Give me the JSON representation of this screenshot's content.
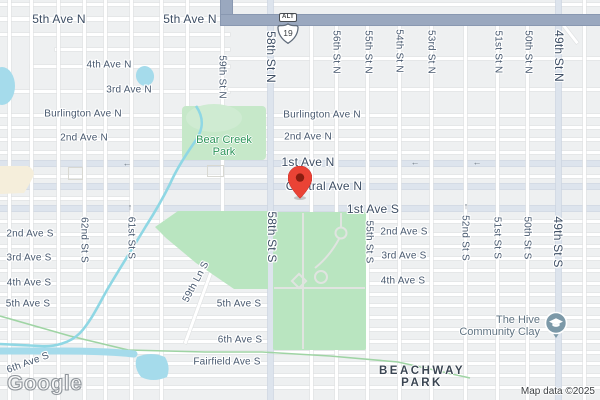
{
  "map": {
    "logo": "Google",
    "attribution": "Map data ©2025",
    "route_shield": {
      "banner": "ALT",
      "number": "19"
    },
    "marker": {
      "label": "Dropped pin",
      "color": "#EA4335"
    },
    "poi": {
      "line1": "The Hive",
      "line2": "Community Clay",
      "icon": "school-pin-icon",
      "color": "#7c99a8"
    },
    "parks": {
      "bear_creek": {
        "line1": "Bear Creek",
        "line2": "Park"
      },
      "beachway": {
        "line1": "BEACHWAY",
        "line2": "PARK"
      }
    },
    "street_labels": [
      {
        "text": "5th Ave N",
        "x": 59,
        "y": 19,
        "size": "lg"
      },
      {
        "text": "5th Ave N",
        "x": 190,
        "y": 19,
        "size": "lg"
      },
      {
        "text": "4th Ave N",
        "x": 109,
        "y": 65,
        "size": "md"
      },
      {
        "text": "3rd Ave N",
        "x": 129,
        "y": 90,
        "size": "md"
      },
      {
        "text": "Burlington Ave N",
        "x": 83,
        "y": 114,
        "size": "md"
      },
      {
        "text": "Burlington Ave N",
        "x": 322,
        "y": 115,
        "size": "md"
      },
      {
        "text": "2nd Ave N",
        "x": 84,
        "y": 138,
        "size": "md"
      },
      {
        "text": "2nd Ave N",
        "x": 308,
        "y": 137,
        "size": "md"
      },
      {
        "text": "1st Ave N",
        "x": 308,
        "y": 162,
        "size": "lg"
      },
      {
        "text": "Central Ave N",
        "x": 324,
        "y": 186,
        "size": "lg"
      },
      {
        "text": "1st Ave S",
        "x": 373,
        "y": 209,
        "size": "lg"
      },
      {
        "text": "2nd Ave S",
        "x": 30,
        "y": 234,
        "size": "md"
      },
      {
        "text": "2nd Ave S",
        "x": 404,
        "y": 232,
        "size": "md"
      },
      {
        "text": "3rd Ave S",
        "x": 29,
        "y": 258,
        "size": "md"
      },
      {
        "text": "3rd Ave S",
        "x": 404,
        "y": 256,
        "size": "md"
      },
      {
        "text": "4th Ave S",
        "x": 29,
        "y": 283,
        "size": "md"
      },
      {
        "text": "4th Ave S",
        "x": 403,
        "y": 281,
        "size": "md"
      },
      {
        "text": "5th Ave S",
        "x": 28,
        "y": 304,
        "size": "md"
      },
      {
        "text": "5th Ave S",
        "x": 239,
        "y": 304,
        "size": "md"
      },
      {
        "text": "6th Ave S",
        "x": 240,
        "y": 340,
        "size": "md"
      },
      {
        "text": "Fairfield Ave S",
        "x": 227,
        "y": 362,
        "size": "md"
      },
      {
        "text": "6th Ave S",
        "x": 28,
        "y": 363,
        "size": "md",
        "rot": -20
      },
      {
        "text": "59th Ln S",
        "x": 196,
        "y": 282,
        "size": "md",
        "rot": -62
      },
      {
        "text": "59th St N",
        "x": 222,
        "y": 77,
        "size": "md",
        "vert": true
      },
      {
        "text": "58th St N",
        "x": 271,
        "y": 57,
        "size": "lg",
        "vert": true
      },
      {
        "text": "56th St N",
        "x": 336,
        "y": 52,
        "size": "md",
        "vert": true
      },
      {
        "text": "55th St N",
        "x": 368,
        "y": 52,
        "size": "md",
        "vert": true
      },
      {
        "text": "54th St N",
        "x": 399,
        "y": 51,
        "size": "md",
        "vert": true
      },
      {
        "text": "53rd St N",
        "x": 431,
        "y": 52,
        "size": "md",
        "vert": true
      },
      {
        "text": "51st St N",
        "x": 498,
        "y": 52,
        "size": "md",
        "vert": true
      },
      {
        "text": "50th St N",
        "x": 528,
        "y": 52,
        "size": "md",
        "vert": true
      },
      {
        "text": "49th St N",
        "x": 559,
        "y": 56,
        "size": "lg",
        "vert": true
      },
      {
        "text": "62nd St S",
        "x": 84,
        "y": 240,
        "size": "md",
        "vert": true
      },
      {
        "text": "61st St S",
        "x": 131,
        "y": 238,
        "size": "md",
        "vert": true
      },
      {
        "text": "58th St S",
        "x": 272,
        "y": 237,
        "size": "lg",
        "vert": true
      },
      {
        "text": "55th St S",
        "x": 369,
        "y": 242,
        "size": "md",
        "vert": true
      },
      {
        "text": "52nd St S",
        "x": 465,
        "y": 238,
        "size": "md",
        "vert": true
      },
      {
        "text": "51st St S",
        "x": 497,
        "y": 238,
        "size": "md",
        "vert": true
      },
      {
        "text": "50th St S",
        "x": 527,
        "y": 238,
        "size": "md",
        "vert": true
      },
      {
        "text": "49th St S",
        "x": 558,
        "y": 242,
        "size": "lg",
        "vert": true
      }
    ],
    "arrows": [
      {
        "glyph": "←",
        "x": 127,
        "y": 163
      },
      {
        "glyph": "←",
        "x": 415,
        "y": 162
      },
      {
        "glyph": "←",
        "x": 477,
        "y": 162
      },
      {
        "glyph": "↑",
        "x": 130,
        "y": 207
      },
      {
        "glyph": "↑",
        "x": 466,
        "y": 206
      }
    ],
    "colors": {
      "land": "#eef0f1",
      "road_minor": "#ffffff",
      "road_major": "#dde4ed",
      "highway": "#9aa8bf",
      "park": "#b9e5c0",
      "water": "#a5dbeb",
      "label": "#47586e",
      "park_label": "#2a9457",
      "marker_red": "#EA4335",
      "poi_blue_gray": "#7c99a8"
    }
  }
}
